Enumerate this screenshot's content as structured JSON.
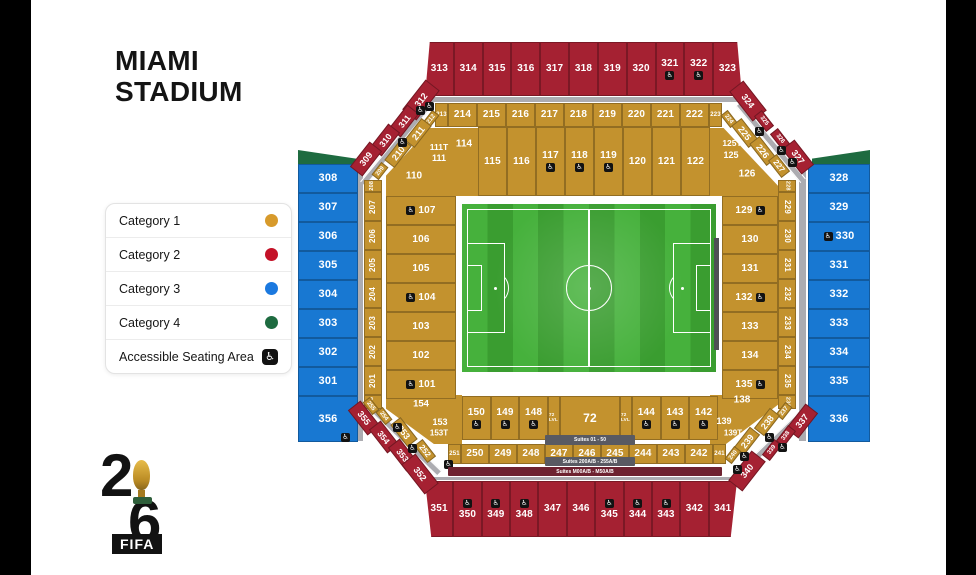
{
  "title": {
    "line1": "MIAMI",
    "line2": "STADIUM"
  },
  "legend": {
    "items": [
      {
        "label": "Category 1",
        "type": "dot",
        "color": "#D79A2B"
      },
      {
        "label": "Category 2",
        "type": "dot",
        "color": "#C41228"
      },
      {
        "label": "Category 3",
        "type": "dot",
        "color": "#1B79DF"
      },
      {
        "label": "Category 4",
        "type": "dot",
        "color": "#1E6B40"
      },
      {
        "label": "Accessible Seating Area",
        "type": "accessible-icon"
      }
    ]
  },
  "logo": {
    "digit_top": "2",
    "digit_bottom": "6",
    "wordmark": "FIFA",
    "trophy": "world-cup-trophy-icon"
  },
  "colors": {
    "gold": "#C3922E",
    "red": "#A52132",
    "blue": "#1878D2",
    "green": "#1E6B40",
    "walkway": "#ACACB1",
    "suites_bar": "#595A62",
    "suites_bar_maroon": "#6E2230",
    "field_stripe_a": "#46B13C",
    "field_stripe_b": "#3A9D30",
    "dark_bar": "#4F5055",
    "accessible_badge": "#121212"
  },
  "accessible_glyph": "♿",
  "stadium": {
    "outer_top": [
      {
        "n": "313"
      },
      {
        "n": "314"
      },
      {
        "n": "315"
      },
      {
        "n": "316"
      },
      {
        "n": "317"
      },
      {
        "n": "318"
      },
      {
        "n": "319"
      },
      {
        "n": "320"
      },
      {
        "n": "321",
        "acc": true
      },
      {
        "n": "322",
        "acc": true
      },
      {
        "n": "323"
      }
    ],
    "outer_bottom": [
      {
        "n": "351"
      },
      {
        "n": "350",
        "acc": true
      },
      {
        "n": "349",
        "acc": true
      },
      {
        "n": "348",
        "acc": true
      },
      {
        "n": "347"
      },
      {
        "n": "346"
      },
      {
        "n": "345",
        "acc": true
      },
      {
        "n": "344",
        "acc": true
      },
      {
        "n": "343",
        "acc": true
      },
      {
        "n": "342"
      },
      {
        "n": "341"
      }
    ],
    "blue_left": [
      {
        "n": "308"
      },
      {
        "n": "307"
      },
      {
        "n": "306"
      },
      {
        "n": "305"
      },
      {
        "n": "304"
      },
      {
        "n": "303"
      },
      {
        "n": "302"
      },
      {
        "n": "301"
      },
      {
        "n": "356"
      }
    ],
    "blue_right": [
      {
        "n": "328"
      },
      {
        "n": "329"
      },
      {
        "n": "330",
        "acc": true
      },
      {
        "n": "331"
      },
      {
        "n": "332"
      },
      {
        "n": "333"
      },
      {
        "n": "334"
      },
      {
        "n": "335"
      },
      {
        "n": "336"
      }
    ],
    "gold_top_200": [
      {
        "n": "213",
        "tiny": true
      },
      {
        "n": "214"
      },
      {
        "n": "215"
      },
      {
        "n": "216"
      },
      {
        "n": "217"
      },
      {
        "n": "218"
      },
      {
        "n": "219"
      },
      {
        "n": "220"
      },
      {
        "n": "221"
      },
      {
        "n": "222"
      },
      {
        "n": "223",
        "tiny": true
      }
    ],
    "gold_bottom_200": [
      {
        "n": "251",
        "tiny": true
      },
      {
        "n": "250"
      },
      {
        "n": "249"
      },
      {
        "n": "248"
      },
      {
        "n": "247"
      },
      {
        "n": "246"
      },
      {
        "n": "245"
      },
      {
        "n": "244"
      },
      {
        "n": "243"
      },
      {
        "n": "242"
      },
      {
        "n": "241",
        "tiny": true
      }
    ],
    "strip_left_200": [
      {
        "n": "208",
        "tiny": true
      },
      {
        "n": "207"
      },
      {
        "n": "206"
      },
      {
        "n": "205"
      },
      {
        "n": "204"
      },
      {
        "n": "203"
      },
      {
        "n": "202"
      },
      {
        "n": "201"
      },
      {
        "n": "256",
        "tiny": true
      }
    ],
    "strip_right_200": [
      {
        "n": "228",
        "tiny": true
      },
      {
        "n": "229"
      },
      {
        "n": "230"
      },
      {
        "n": "231"
      },
      {
        "n": "232"
      },
      {
        "n": "233"
      },
      {
        "n": "234"
      },
      {
        "n": "235"
      },
      {
        "n": "236",
        "tiny": true
      }
    ],
    "inner_top_100": [
      {
        "n": "115"
      },
      {
        "n": "116"
      },
      {
        "n": "117",
        "acc": true
      },
      {
        "n": "118",
        "acc": true
      },
      {
        "n": "119",
        "acc": true
      },
      {
        "n": "120"
      },
      {
        "n": "121"
      },
      {
        "n": "122"
      }
    ],
    "inner_left_100": [
      {
        "n": "107",
        "acc": true
      },
      {
        "n": "106"
      },
      {
        "n": "105"
      },
      {
        "n": "104",
        "acc": true
      },
      {
        "n": "103"
      },
      {
        "n": "102"
      },
      {
        "n": "101",
        "acc": true
      }
    ],
    "inner_right_100": [
      {
        "n": "129",
        "acc": true
      },
      {
        "n": "130"
      },
      {
        "n": "131"
      },
      {
        "n": "132",
        "acc": true
      },
      {
        "n": "133"
      },
      {
        "n": "134"
      },
      {
        "n": "135",
        "acc": true
      }
    ],
    "inner_bottom_100": [
      {
        "n": "150",
        "acc": true
      },
      {
        "n": "149",
        "acc": true
      },
      {
        "n": "148",
        "acc": true
      },
      {
        "n": "72",
        "big": true
      },
      {
        "n": "144",
        "acc": true
      },
      {
        "n": "143",
        "acc": true
      },
      {
        "n": "142",
        "acc": true
      }
    ],
    "lvl_label": "72 LVL",
    "corner_labels": {
      "tl": [
        "110",
        "111T",
        "111",
        "114"
      ],
      "tr": [
        "125T",
        "125",
        "126"
      ],
      "bl": [
        "154",
        "153",
        "153T"
      ],
      "br": [
        "138",
        "139",
        "139T"
      ]
    },
    "diag_red_tl": [
      "312",
      "311",
      "310",
      "309"
    ],
    "diag_red_tr": [
      "324",
      "325",
      "326",
      "327"
    ],
    "diag_red_bl": [
      "355",
      "354",
      "353",
      "352"
    ],
    "diag_red_br": [
      "337",
      "338",
      "339",
      "340"
    ],
    "diag_gold_tl": [
      "212",
      "211",
      "210",
      "209"
    ],
    "diag_gold_tr": [
      "224",
      "225",
      "226",
      "227"
    ],
    "diag_gold_bl": [
      "255",
      "254",
      "253",
      "252"
    ],
    "diag_gold_br": [
      "237",
      "238",
      "239",
      "240"
    ],
    "suites": [
      "Suites 01 - 50",
      "Suites 200A/B - 255A/B",
      "Suites M00A/B - M50A/B"
    ]
  }
}
